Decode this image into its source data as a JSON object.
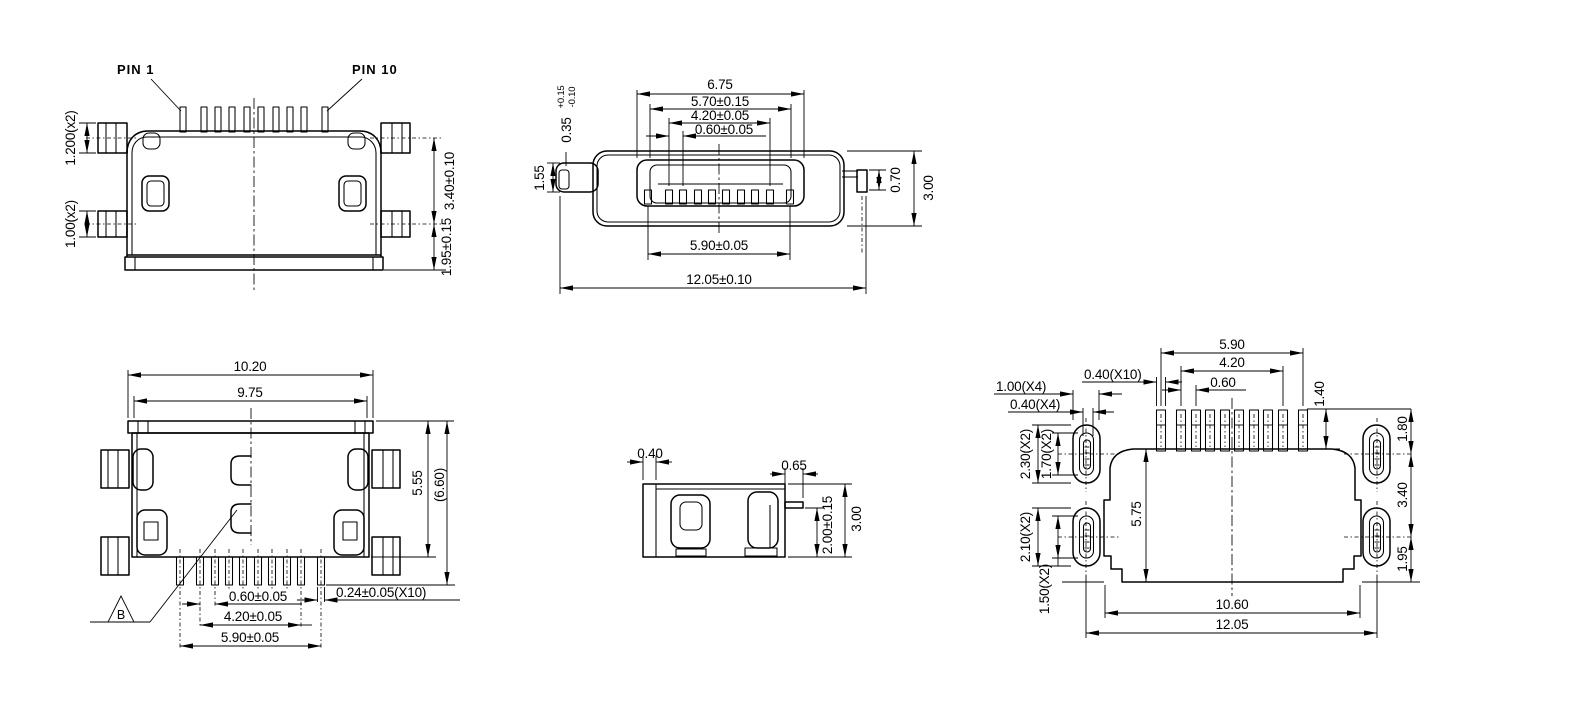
{
  "drawing": {
    "title": "connector-engineering-drawing",
    "background": "#ffffff",
    "line_color": "#000000",
    "views": {
      "front": {
        "pin1": "PIN 1",
        "pin10": "PIN 10",
        "tab_upper": "1.200(x2)",
        "tab_lower": "1.00(x2)",
        "tab_pitch": "3.40±0.10",
        "base_height": "1.95±0.15"
      },
      "mating_face": {
        "opening_width": "6.75",
        "shell_inner_width": "5.70±0.15",
        "contact_span": "4.20±0.05",
        "contact_pitch": "0.60±0.05",
        "step_value": "0.35",
        "step_tol_plus": "+0.15",
        "step_tol_minus": "-0.10",
        "side_tab_height": "1.55",
        "solder_pin_height": "0.70",
        "body_height": "3.00",
        "shield_contact_span": "5.90±0.05",
        "overall_width": "12.05±0.10"
      },
      "bottom": {
        "overall_width": "10.20",
        "shell_width": "9.75",
        "body_depth": "5.55",
        "overall_depth": "(6.60)",
        "lead_pitch": "0.60±0.05",
        "lead_span_inner": "4.20±0.05",
        "lead_span_outer": "5.90±0.05",
        "lead_width": "0.24±0.05(X10)",
        "datum": "B"
      },
      "side": {
        "shell_thickness": "0.40",
        "lead_length": "0.65",
        "lead_height": "2.00±0.15",
        "overall_height": "3.00"
      },
      "footprint": {
        "pad_span_outer": "5.90",
        "pad_span_inner": "4.20",
        "pad_pitch": "0.60",
        "pad_width": "0.40(X10)",
        "hole_width": "1.00(X4)",
        "hole_slot_width": "0.40(X4)",
        "hole_length_upper": "2.30(X2)",
        "slot_length_upper": "1.70(X2)",
        "hole_length_lower": "2.10(X2)",
        "slot_length_lower": "1.50(X2)",
        "pad_length": "1.40",
        "body_depth": "5.75",
        "body_width": "10.60",
        "overall_width": "12.05",
        "edge_to_upper_hole": "1.80",
        "hole_spacing": "3.40",
        "lower_hole_to_edge": "1.95"
      }
    }
  }
}
